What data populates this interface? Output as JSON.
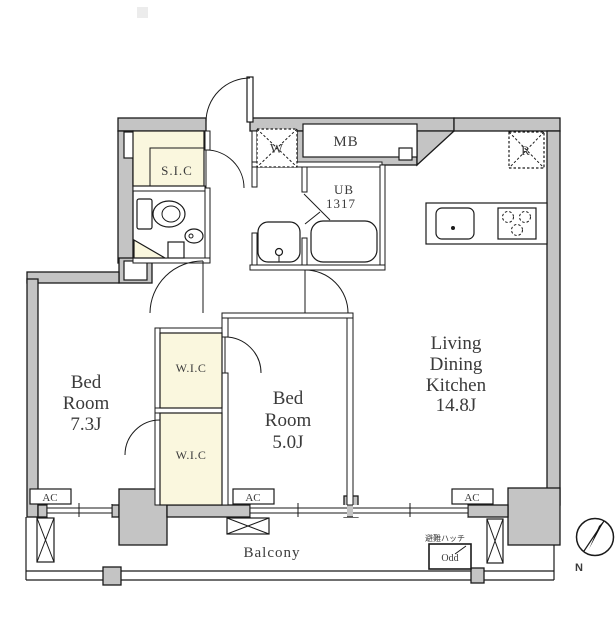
{
  "plan": {
    "rooms": {
      "bedroom1": {
        "lines": [
          "Bed",
          "Room",
          "7.3J"
        ]
      },
      "bedroom2": {
        "lines": [
          "Bed",
          "Room",
          "5.0J"
        ]
      },
      "ldk": {
        "lines": [
          "Living",
          "Dining",
          "Kitchen",
          "14.8J"
        ]
      },
      "sic": {
        "label": "S.I.C"
      },
      "wic_upper": {
        "label": "W.I.C"
      },
      "wic_lower": {
        "label": "W.I.C"
      },
      "unit_bath": {
        "lines": [
          "UB",
          "1317"
        ]
      },
      "balcony": {
        "label": "Balcony"
      }
    },
    "fixtures": {
      "meter_box": "MB",
      "washer": "W",
      "fridge": "R",
      "ac": "AC",
      "hatch_label": "避難ハッチ",
      "hatch_sub": "Odd",
      "compass_north": "N"
    },
    "colors": {
      "wall": "#c4c4c4",
      "closet": "#faf7de",
      "line": "#1a1a1a",
      "text": "#3b3b3b"
    }
  }
}
